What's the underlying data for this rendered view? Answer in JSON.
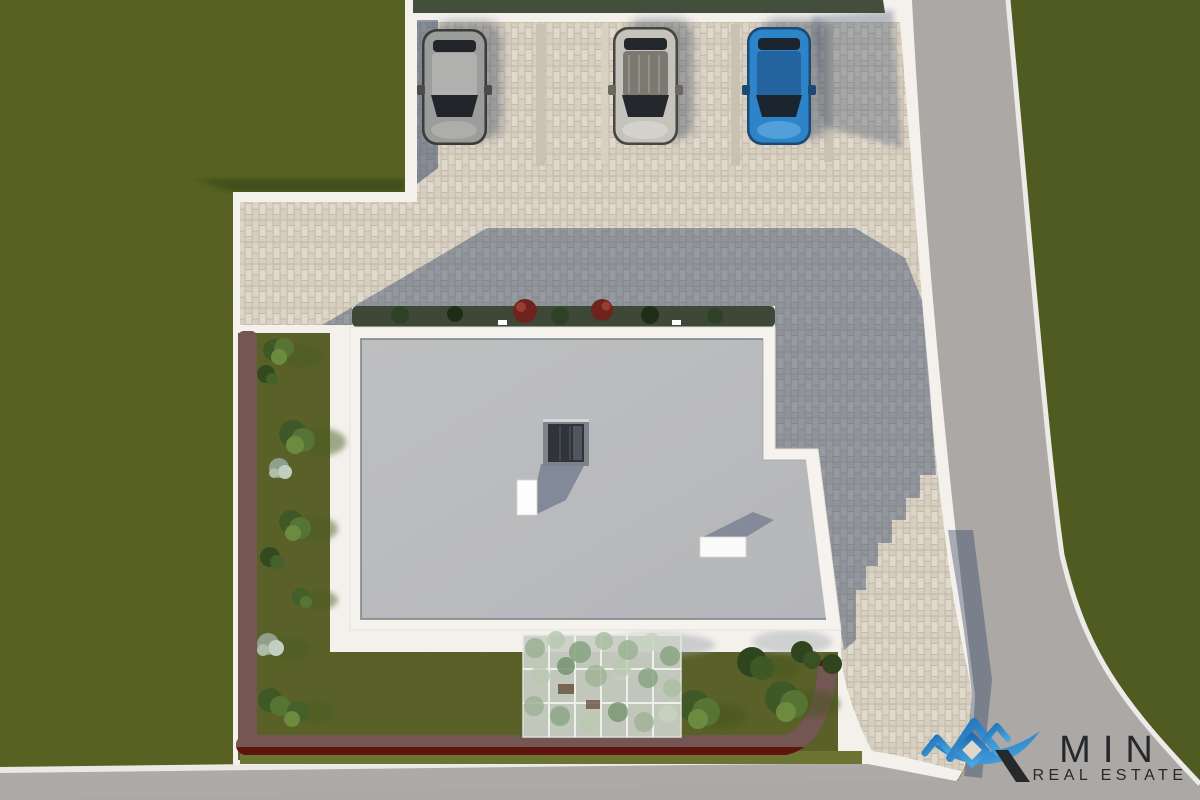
{
  "logo": {
    "brand": "MIN",
    "subtitle": "REAL ESTATE",
    "icon": "mountain-peaks-diamond-swoosh",
    "blue": "#2a7fc3",
    "blue_light": "#4aa7e0",
    "blue_dark": "#1b6cb3",
    "text_color": "#26292c"
  },
  "scene": {
    "description": "aerial top-down 3D render of a residential building plot with parking, gardens and access roads",
    "palette": {
      "grass": "#75842f",
      "grass_right": "#6f7f2e",
      "garden": "#7c8838",
      "garden_light_strip": "#87923e",
      "pavement_base": "#e9e1d3",
      "road": "#b7b4b1",
      "curb_white": "#f1efec",
      "plot_white": "#f4f1ec",
      "parapet": "#f6f3ef",
      "roof": "#c7c8ca",
      "shadow": "#2f4263",
      "hedge_dark_green": "#22301a",
      "hedge_maroon": "#5e150e"
    },
    "parking": {
      "visible_cars": 3,
      "divider_color": "#c9c1b2"
    },
    "cars": [
      {
        "name": "silver-car",
        "body": "#9c9c9a",
        "roof": "#b0b0ae",
        "glass": "#22262b"
      },
      {
        "name": "white-car",
        "body": "#c6c3bd",
        "roof": "#7c7970",
        "glass": "#24272c"
      },
      {
        "name": "blue-car",
        "body": "#2e84c8",
        "roof": "#2364a0",
        "glass": "#1b2530"
      }
    ],
    "building": {
      "roof_type": "flat roof with white parapet",
      "features": [
        "dark glass skylight",
        "white chimney",
        "white roof vent"
      ]
    },
    "garden": {
      "border": "maroon hedge",
      "elements": [
        "trees",
        "bushes",
        "white flowering shrubs",
        "red flowering shrubs",
        "pergola with climbing plants"
      ]
    }
  }
}
